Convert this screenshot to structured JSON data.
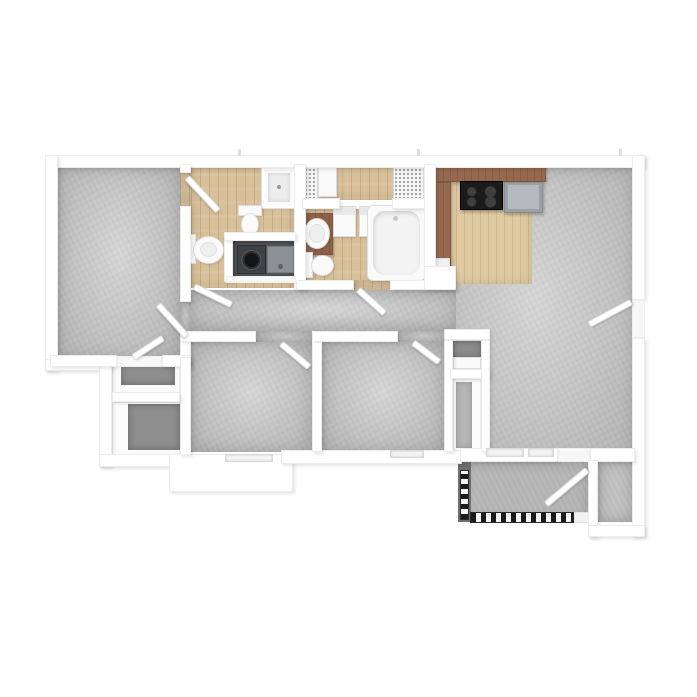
{
  "scene": {
    "type": "3d-floor-plan-top-down-rendering",
    "background": "#ffffff",
    "visible_text": "none"
  },
  "palette": {
    "background": "#ffffff",
    "wall": "#ffffff",
    "wall_edge": "#ececec",
    "carpet": "#cccccc",
    "closet_floor": "#8e8e8e",
    "wood": "#d8c09a",
    "kitchen_wood": "#e0caa2",
    "cabinet": "#96684e",
    "stove": "#1b1b1b",
    "fridge": "#9aa1a6",
    "washer_body": "#3f4245",
    "washer_door": "#141414",
    "dryer": "#8c9196",
    "laundry_floor": "#57585a",
    "patio_floor": "#b7b7b7",
    "patio_wall": "#6f6f71",
    "railing_dark": "#1b1b1b",
    "railing_light": "#f4f4f4",
    "storage_floor": "#c3c3c3",
    "fixture_white": "#fafafa",
    "window_fill": "#f4f4f4"
  },
  "rooms": [
    {
      "name": "primary-bedroom",
      "floor": "carpet"
    },
    {
      "name": "ensuite-bathroom",
      "floor": "wood"
    },
    {
      "name": "laundry-closet",
      "floor": "dark"
    },
    {
      "name": "hall-bathroom",
      "floor": "wood"
    },
    {
      "name": "dressing-closet",
      "floor": "wood"
    },
    {
      "name": "hallway",
      "floor": "carpet"
    },
    {
      "name": "bedroom-2",
      "floor": "carpet"
    },
    {
      "name": "bedroom-3",
      "floor": "carpet"
    },
    {
      "name": "primary-walk-in-closet",
      "floor": "dark-carpet"
    },
    {
      "name": "primary-storage-closet",
      "floor": "dark-carpet"
    },
    {
      "name": "bedroom-3-closet",
      "floor": "dark-carpet"
    },
    {
      "name": "coat-closet",
      "floor": "carpet"
    },
    {
      "name": "kitchen",
      "floor": "wood"
    },
    {
      "name": "living-dining-room",
      "floor": "carpet"
    },
    {
      "name": "patio",
      "floor": "concrete"
    },
    {
      "name": "outdoor-storage",
      "floor": "concrete"
    }
  ],
  "fixtures": [
    "shower",
    "toilet",
    "pedestal-sink",
    "washer",
    "dryer",
    "vanity-sink",
    "bathtub",
    "wire-shelf",
    "linen-cabinet",
    "range",
    "refrigerator",
    "kitchen-counter",
    "upper-cabinets",
    "patio-railing",
    "window",
    "entry-door",
    "patio-door",
    "interior-door"
  ]
}
